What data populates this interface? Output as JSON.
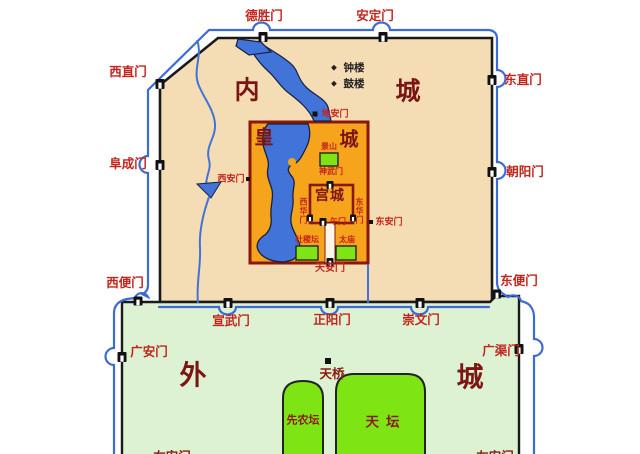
{
  "map": {
    "title": "Old Beijing city walls map",
    "colors": {
      "inner_city_fill": "#F4DDB5",
      "outer_city_fill": "#DCF2D3",
      "imperial_fill": "#F6A41C",
      "water": "#4273D9",
      "moat": "#3C6BD6",
      "site_green": "#7FE414",
      "wall": "#1A1A1A",
      "imperial_wall": "#8A1708",
      "gate_label": "#C3241C",
      "region_label": "#7C1412",
      "corridor_fill": "#FDF6E8"
    },
    "regions": {
      "inner_city": {
        "char1": "内",
        "char2": "城"
      },
      "outer_city": {
        "char1": "外",
        "char2": "城"
      },
      "imperial_city": {
        "char1": "皇",
        "char2": "城"
      },
      "palace_city": "宫城"
    },
    "gates": {
      "deshengmen": "德胜门",
      "andingmen": "安定门",
      "xizhimen": "西直门",
      "fuchengmen": "阜成门",
      "dongzhimen": "东直门",
      "chaoyangmen": "朝阳门",
      "xibianmen": "西便门",
      "dongbianmen": "东便门",
      "xuanwumen": "宣武门",
      "zhengyangmen": "正阳门",
      "chongwenmen": "崇文门",
      "guanganmen": "广安门",
      "guangqumen": "广渠门",
      "diananmen": "地安门",
      "shenwumen": "神武门",
      "wumen": "午门",
      "xihuamen": "西华门",
      "donghuamen": "东华门",
      "xianmen": "西安门",
      "donganmen": "东安门",
      "tiananmen": "天安门",
      "youanmen": "右安门",
      "zuoanmen": "左安门"
    },
    "landmarks": {
      "bell_tower": "钟楼",
      "drum_tower": "鼓楼",
      "jingshan": "景山",
      "shejitan": "社稷坛",
      "taimiao": "太庙",
      "tianqiao": "天桥",
      "xiannongtan": "先农坛",
      "tiantan": "天坛"
    },
    "icons": {
      "tower_bullet": "◆"
    }
  }
}
